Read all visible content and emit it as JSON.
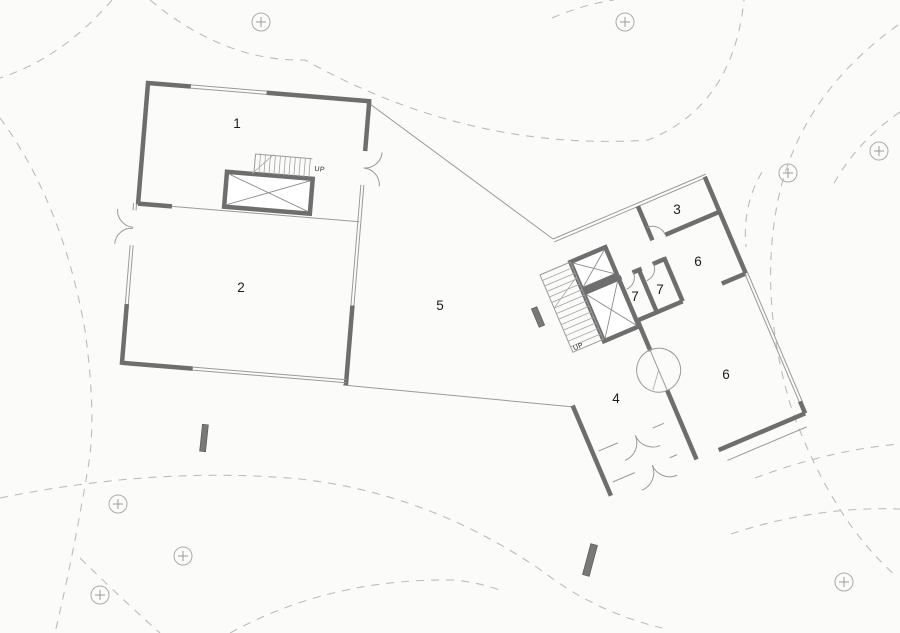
{
  "document": {
    "type": "architectural floor plan",
    "description": "site plan with two rotated building volumes, tree canopies (dashed) and trunk markers"
  },
  "rooms": [
    {
      "id": "room-1",
      "label": "1"
    },
    {
      "id": "room-2",
      "label": "2"
    },
    {
      "id": "room-3",
      "label": "3"
    },
    {
      "id": "room-4",
      "label": "4"
    },
    {
      "id": "room-5",
      "label": "5"
    },
    {
      "id": "room-6-upper",
      "label": "6"
    },
    {
      "id": "room-6-lower",
      "label": "6"
    },
    {
      "id": "room-7-left",
      "label": "7"
    },
    {
      "id": "room-7-right",
      "label": "7"
    }
  ],
  "stairs": {
    "left_building_up_label": "UP",
    "right_building_up_label": "UP"
  },
  "icons": {
    "tree_trunk_marker": "circle-plus",
    "elevator_shaft": "x-cross-box"
  },
  "colors": {
    "background": "#fbfbf9",
    "wall": "#6e6e6e",
    "thin_line": "#9a9a9a",
    "tree_canopy_dash": "#bcbcbc",
    "trunk_marker": "#ababab",
    "label_text": "#1c1c1c"
  },
  "site": {
    "tree_trunk_marker_count": 8,
    "column_marker_count": 3
  }
}
